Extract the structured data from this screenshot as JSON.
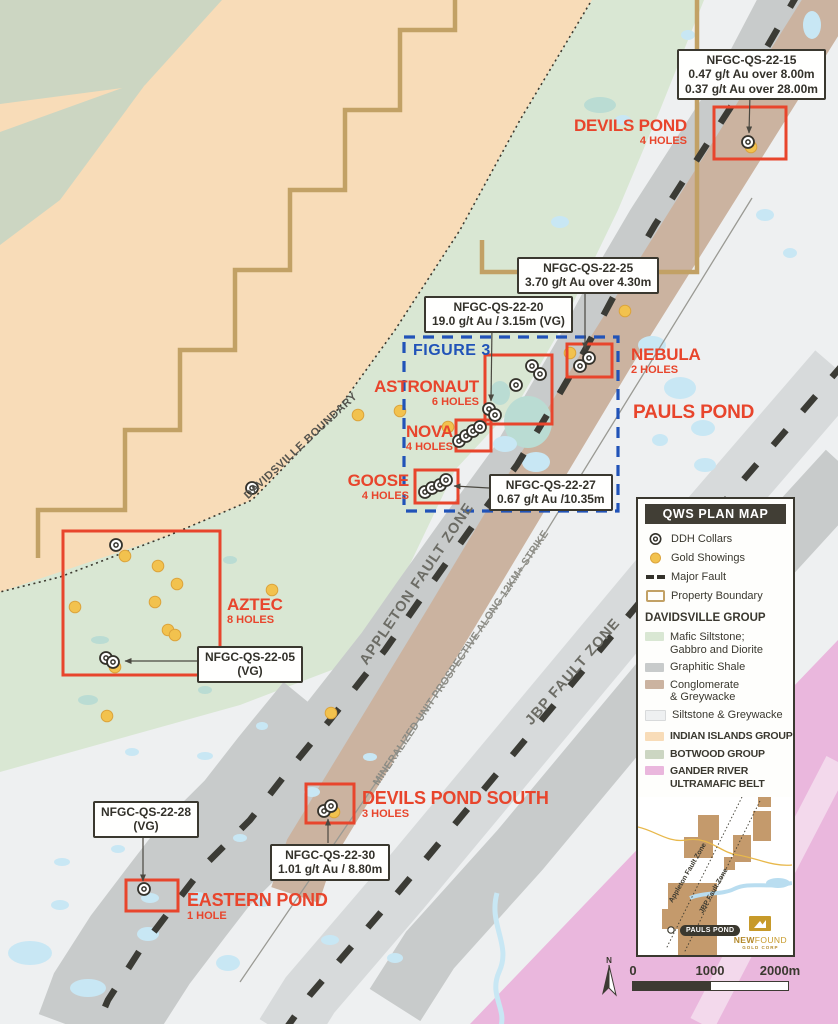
{
  "colors": {
    "accent_red": "#e8452c",
    "figure_blue": "#2153b8",
    "gold": "#f2c24e",
    "boundary_tan": "#c2a165",
    "legend_header_bg": "#413e35"
  },
  "map": {
    "figure_box": {
      "label": "FIGURE 3",
      "x": 404,
      "y": 337,
      "w": 214,
      "h": 174
    },
    "area_label": {
      "text": "PAULS POND",
      "x": 633,
      "y": 403,
      "size": 19
    },
    "region_labels": [
      {
        "text": "DAVIDSVILLE BOUNDARY",
        "cx": 301,
        "cy": 446,
        "rotate": -43,
        "size": 11,
        "color": "#55544e",
        "spacing": 0.6
      },
      {
        "text": "APPLETON FAULT ZONE",
        "cx": 417,
        "cy": 584,
        "rotate": -56,
        "size": 14.5,
        "color": "#6c6c65",
        "spacing": 1
      },
      {
        "text": "MINERALIZED UNIT PROSPECTIVE ALONG 12KM+ STRIKE",
        "cx": 461,
        "cy": 658,
        "rotate": -56,
        "size": 10.5,
        "color": "#8b8b84",
        "spacing": 0.2
      },
      {
        "text": "JBP FAULT ZONE",
        "cx": 573,
        "cy": 672,
        "rotate": -49,
        "size": 14.5,
        "color": "#6c6c65",
        "spacing": 1
      }
    ],
    "prospects": [
      {
        "name": "DEVILS POND",
        "holes": "4 HOLES",
        "box": [
          714,
          107,
          72,
          52
        ],
        "label": {
          "x": 687,
          "y": 117,
          "align": "right",
          "size": 17
        }
      },
      {
        "name": "NEBULA",
        "holes": "2 HOLES",
        "box": [
          567,
          344,
          45,
          33
        ],
        "label": {
          "x": 631,
          "y": 346,
          "align": "left",
          "size": 17
        }
      },
      {
        "name": "ASTRONAUT",
        "holes": "6 HOLES",
        "box": [
          485,
          355,
          67,
          69
        ],
        "label": {
          "x": 479,
          "y": 378,
          "align": "right",
          "size": 17
        }
      },
      {
        "name": "NOVA",
        "holes": "4 HOLES",
        "box": [
          456,
          420,
          35,
          31
        ],
        "label": {
          "x": 453,
          "y": 423,
          "align": "right",
          "size": 17
        }
      },
      {
        "name": "GOOSE",
        "holes": "4 HOLES",
        "box": [
          415,
          470,
          43,
          33
        ],
        "label": {
          "x": 409,
          "y": 472,
          "align": "right",
          "size": 17
        }
      },
      {
        "name": "AZTEC",
        "holes": "8 HOLES",
        "box": [
          63,
          531,
          157,
          144
        ],
        "label": {
          "x": 227,
          "y": 596,
          "align": "left",
          "size": 17
        }
      },
      {
        "name": "DEVILS POND SOUTH",
        "holes": "3 HOLES",
        "box": [
          306,
          784,
          48,
          39
        ],
        "label": {
          "x": 362,
          "y": 789,
          "align": "left",
          "size": 18
        }
      },
      {
        "name": "EASTERN POND",
        "holes": "1 HOLE",
        "box": [
          126,
          880,
          52,
          31
        ],
        "label": {
          "x": 187,
          "y": 891,
          "align": "left",
          "size": 18
        }
      }
    ],
    "callouts": [
      {
        "lines": [
          "NFGC-QS-22-15",
          "0.47 g/t Au over 8.00m",
          "0.37 g/t Au over 28.00m"
        ],
        "x": 677,
        "y": 49,
        "leader": [
          [
            750,
            94
          ],
          [
            749,
            133
          ]
        ]
      },
      {
        "lines": [
          "NFGC-QS-22-25",
          "3.70 g/t Au over 4.30m"
        ],
        "x": 517,
        "y": 257,
        "leader": [
          [
            585,
            288
          ],
          [
            585,
            349
          ]
        ]
      },
      {
        "lines": [
          "NFGC-QS-22-20",
          "19.0 g/t Au / 3.15m (VG)"
        ],
        "x": 424,
        "y": 296,
        "leader": [
          [
            492,
            327
          ],
          [
            491,
            401
          ]
        ]
      },
      {
        "lines": [
          "NFGC-QS-22-27",
          "0.67 g/t Au /10.35m"
        ],
        "x": 489,
        "y": 474,
        "leader": [
          [
            489,
            488
          ],
          [
            454,
            486
          ]
        ]
      },
      {
        "lines": [
          "NFGC-QS-22-05",
          "(VG)"
        ],
        "x": 197,
        "y": 646,
        "leader": [
          [
            197,
            661
          ],
          [
            125,
            661
          ]
        ]
      },
      {
        "lines": [
          "NFGC-QS-22-28",
          "(VG)"
        ],
        "x": 93,
        "y": 801,
        "leader": [
          [
            143,
            832
          ],
          [
            143,
            881
          ]
        ]
      },
      {
        "lines": [
          "NFGC-QS-22-30",
          "1.01 g/t Au / 8.80m"
        ],
        "x": 270,
        "y": 844,
        "leader": [
          [
            328,
            843
          ],
          [
            328,
            819
          ]
        ]
      }
    ],
    "collars": [
      [
        748,
        142
      ],
      [
        580,
        366
      ],
      [
        589,
        358
      ],
      [
        532,
        366
      ],
      [
        540,
        374
      ],
      [
        516,
        385
      ],
      [
        489,
        409
      ],
      [
        495,
        415
      ],
      [
        459,
        441
      ],
      [
        466,
        436
      ],
      [
        473,
        431
      ],
      [
        480,
        427
      ],
      [
        425,
        492
      ],
      [
        432,
        488
      ],
      [
        440,
        485
      ],
      [
        446,
        480
      ],
      [
        252,
        488
      ],
      [
        116,
        545
      ],
      [
        106,
        658
      ],
      [
        113,
        662
      ],
      [
        324,
        811
      ],
      [
        331,
        806
      ],
      [
        144,
        889
      ]
    ],
    "gold": [
      [
        125,
        556
      ],
      [
        158,
        566
      ],
      [
        177,
        584
      ],
      [
        155,
        602
      ],
      [
        75,
        607
      ],
      [
        168,
        630
      ],
      [
        175,
        635
      ],
      [
        272,
        590
      ],
      [
        107,
        716
      ],
      [
        331,
        713
      ],
      [
        625,
        311
      ],
      [
        570,
        353
      ],
      [
        400,
        411
      ],
      [
        448,
        427
      ],
      [
        358,
        415
      ],
      [
        751,
        147
      ],
      [
        334,
        812
      ],
      [
        115,
        667
      ]
    ]
  },
  "legend": {
    "title": "QWS PLAN MAP",
    "symbols": [
      {
        "icon": "ddh-collar-icon",
        "label": "DDH Collars"
      },
      {
        "icon": "gold-showing-icon",
        "label": "Gold Showings"
      },
      {
        "icon": "major-fault-icon",
        "label": "Major Fault"
      },
      {
        "icon": "property-boundary-icon",
        "label": "Property Boundary"
      }
    ],
    "group_title": "DAVIDSVILLE GROUP",
    "units": [
      {
        "color": "#d9e7d3",
        "label": "Mafic Siltstone;\nGabbro and Diorite"
      },
      {
        "color": "#c8cbcb",
        "label": "Graphitic Shale"
      },
      {
        "color": "#cbb3a0",
        "label": "Conglomerate\n& Greywacke"
      },
      {
        "color": "#eef0f1",
        "label": "Siltstone & Greywacke"
      }
    ],
    "groups": [
      {
        "color": "#f8dcb8",
        "label": "INDIAN ISLANDS GROUP"
      },
      {
        "color": "#ccd6c2",
        "label": "BOTWOOD GROUP"
      },
      {
        "color": "#eab7dd",
        "label": "GANDER RIVER\nULTRAMAFIC BELT"
      }
    ]
  },
  "inset": {
    "appleton_label": "Appleton Fault Zone",
    "jbp_label": "JBP Fault Zone",
    "marker_label": "PAULS POND",
    "logo_top_bold": "NEW",
    "logo_top_light": "FOUND",
    "logo_bottom": "GOLD CORP"
  },
  "scalebar": {
    "north": "N",
    "ticks": [
      "0",
      "1000",
      "2000m"
    ]
  }
}
